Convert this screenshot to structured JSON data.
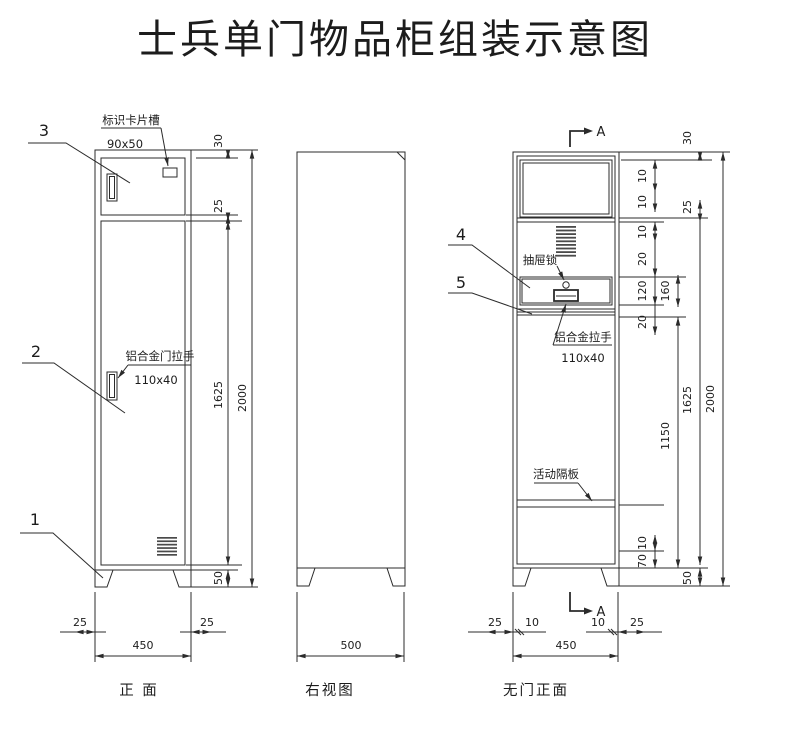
{
  "title": "士兵单门物品柜组装示意图",
  "view_labels": {
    "front": "正    面",
    "side": "右视图",
    "nodoor": "无门正面"
  },
  "parts": {
    "p1": "1",
    "p2": "2",
    "p3": "3",
    "p4": "4",
    "p5": "5"
  },
  "callouts": {
    "card_slot": "标识卡片槽",
    "card_slot_size": "90x50",
    "door_handle": "铝合金门拉手",
    "door_handle_size": "110x40",
    "drawer_lock": "抽屉锁",
    "drawer_handle": "铝合金拉手",
    "drawer_handle_size": "110x40",
    "shelf": "活动隔板",
    "section_letter": "A"
  },
  "dims": {
    "front_right": [
      "30",
      "25",
      "1625",
      "50",
      "2000"
    ],
    "front_bottom": [
      "25",
      "25",
      "450"
    ],
    "side_bottom": [
      "500"
    ],
    "nodoor_right": [
      "10",
      "10",
      "10",
      "20",
      "120",
      "20",
      "10",
      "70",
      "160",
      "1150",
      "30",
      "25",
      "1625",
      "50",
      "2000"
    ],
    "nodoor_bottom": [
      "25",
      "10",
      "10",
      "25",
      "450"
    ]
  },
  "line_color": "#2b2b2b"
}
